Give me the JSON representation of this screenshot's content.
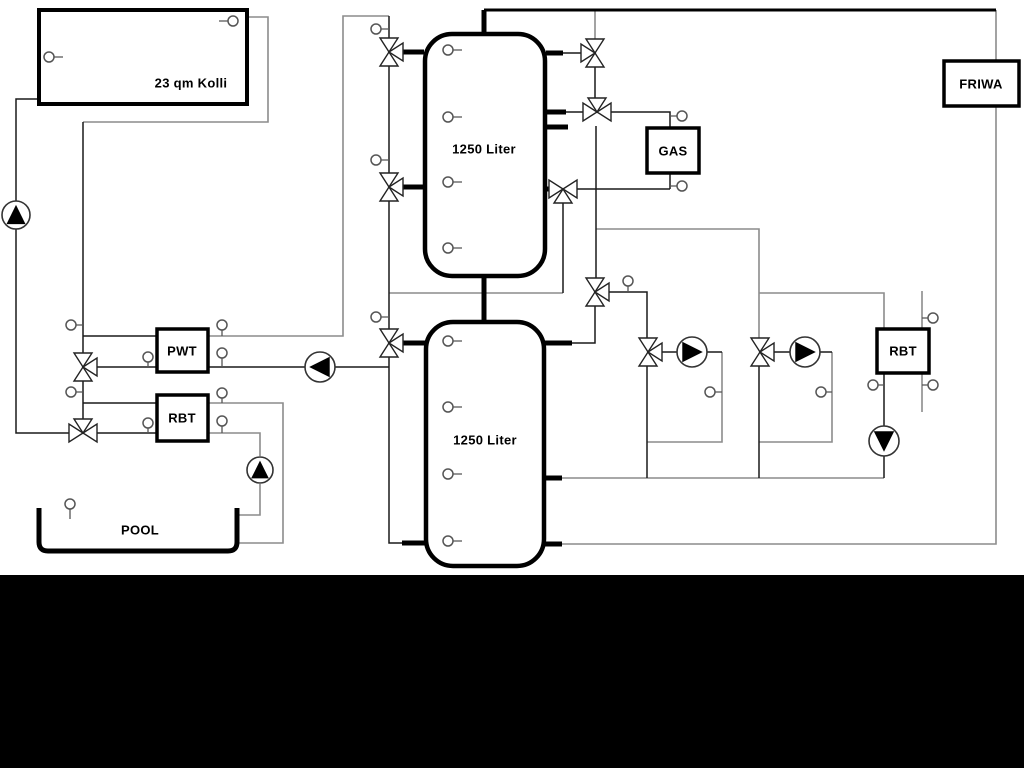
{
  "diagram": {
    "title_context": "hydraulic heating schematic",
    "labels": {
      "collector": "23 qm Kolli",
      "upper_tank": "1250 Liter",
      "lower_tank": "1250 Liter",
      "pwt": "PWT",
      "pool_rbt": "RBT",
      "gas": "GAS",
      "friwa": "FRIWA",
      "heating_rbt": "RBT",
      "pool": "POOL"
    },
    "colors": {
      "pipe_gray": "#8c8c8c",
      "pipe_black": "#1a1a1a",
      "component_border": "#000000",
      "background": "#ffffff",
      "bottom_bar": "#000000"
    }
  }
}
